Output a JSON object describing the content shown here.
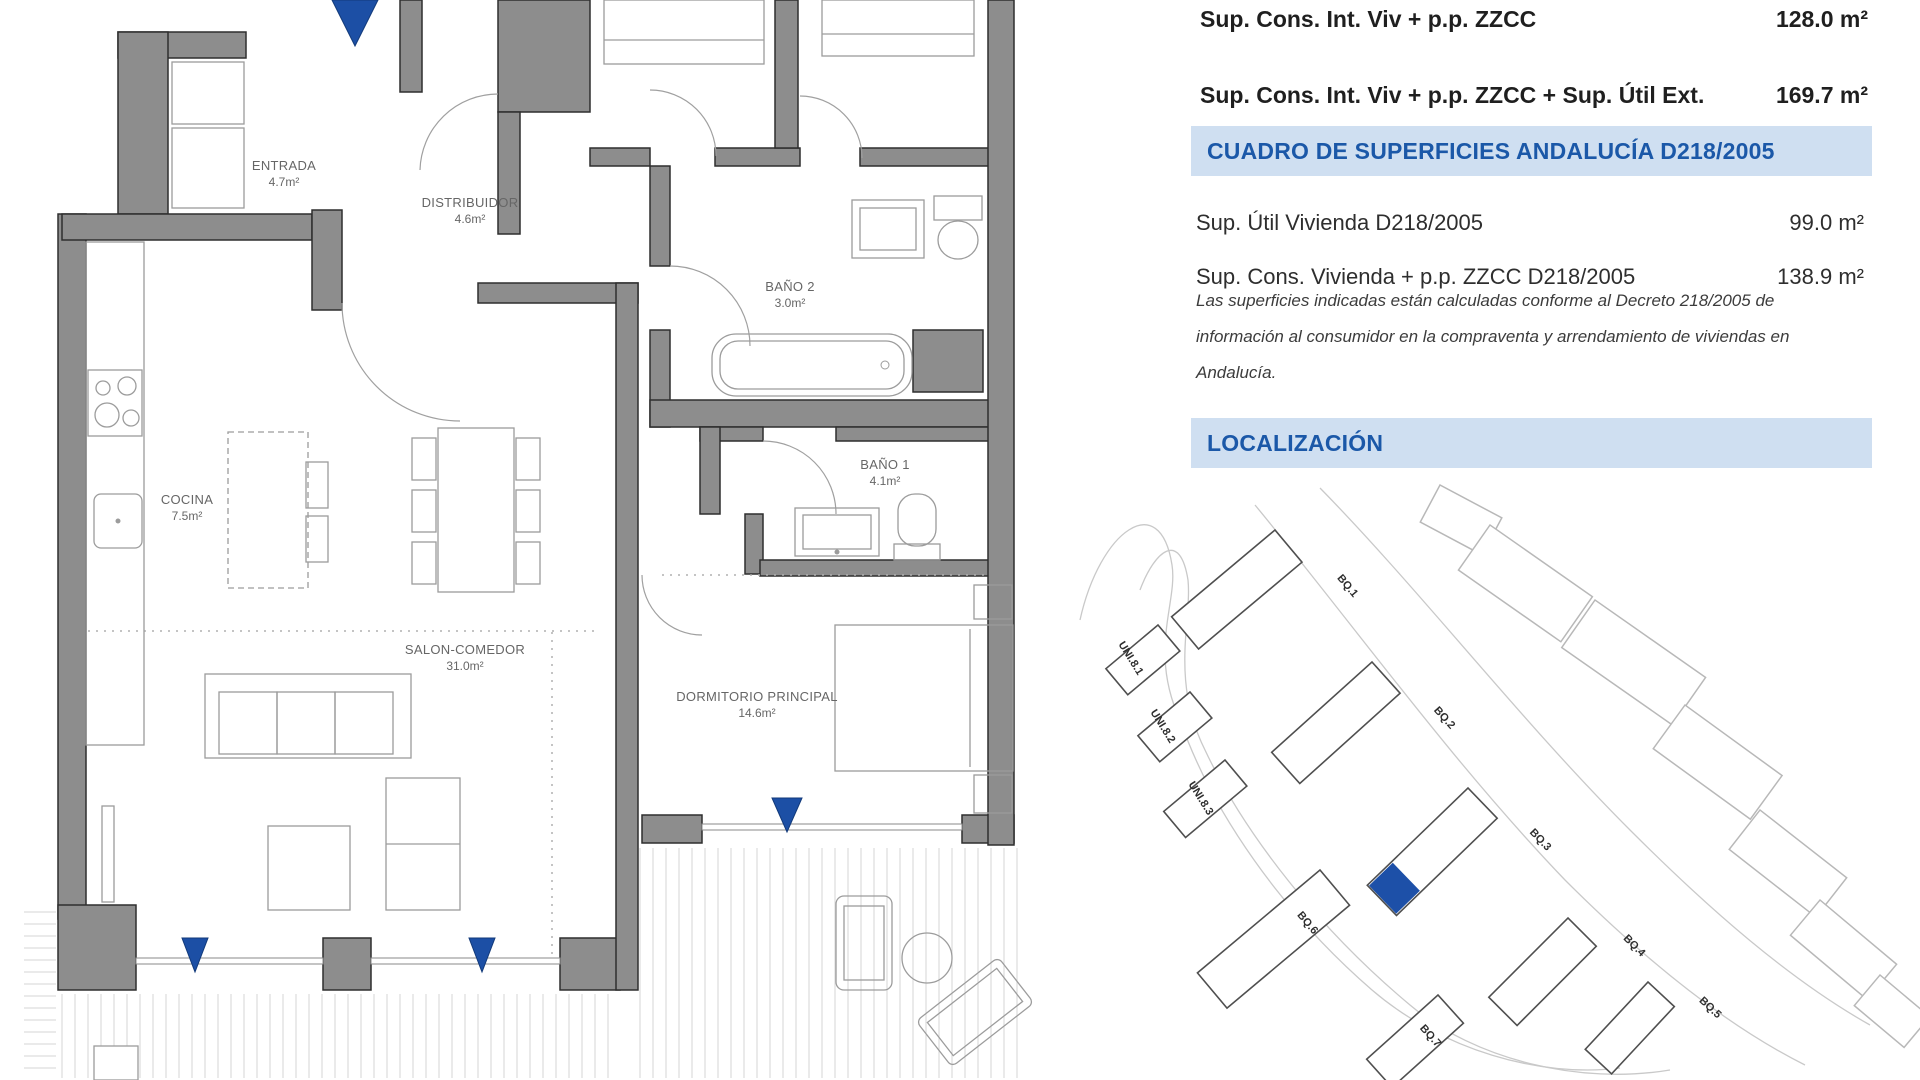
{
  "panel": {
    "summary_rows": [
      {
        "label": "Sup. Cons. Int. Viv + p.p. ZZCC",
        "value": "128.0 m²"
      },
      {
        "label": "Sup. Cons. Int. Viv + p.p. ZZCC + Sup. Útil Ext.",
        "value": "169.7 m²"
      }
    ],
    "cuadro": {
      "header": "CUADRO DE SUPERFICIES ANDALUCÍA D218/2005",
      "rows": [
        {
          "label": "Sup. Útil Vivienda D218/2005",
          "value": "99.0 m²"
        },
        {
          "label": "Sup. Cons. Vivienda + p.p. ZZCC D218/2005",
          "value": "138.9 m²"
        }
      ],
      "note": "Las superficies indicadas están calculadas conforme al Decreto 218/2005 de información al consumidor en la compraventa y arrendamiento de viviendas en Andalucía."
    },
    "localizacion": {
      "header": "LOCALIZACIÓN",
      "blocks": [
        "BQ.1",
        "BQ.2",
        "BQ.3",
        "BQ.4",
        "BQ.5",
        "BQ.6",
        "BQ.7",
        "UNI.8.1",
        "UNI.8.2",
        "UNI.8.3"
      ]
    }
  },
  "floor_plan": {
    "rooms": [
      {
        "name": "ENTRADA",
        "area": "4.7m²"
      },
      {
        "name": "DISTRIBUIDOR",
        "area": "4.6m²"
      },
      {
        "name": "BAÑO 2",
        "area": "3.0m²"
      },
      {
        "name": "COCINA",
        "area": "7.5m²"
      },
      {
        "name": "SALON-COMEDOR",
        "area": "31.0m²"
      },
      {
        "name": "BAÑO 1",
        "area": "4.1m²"
      },
      {
        "name": "DORMITORIO PRINCIPAL",
        "area": "14.6m²"
      }
    ]
  },
  "colors": {
    "accent_blue": "#1b58a8",
    "band_bg": "#cfdff1",
    "highlight_blue": "#1d50a8",
    "wall_gray": "#8d8d8d"
  }
}
